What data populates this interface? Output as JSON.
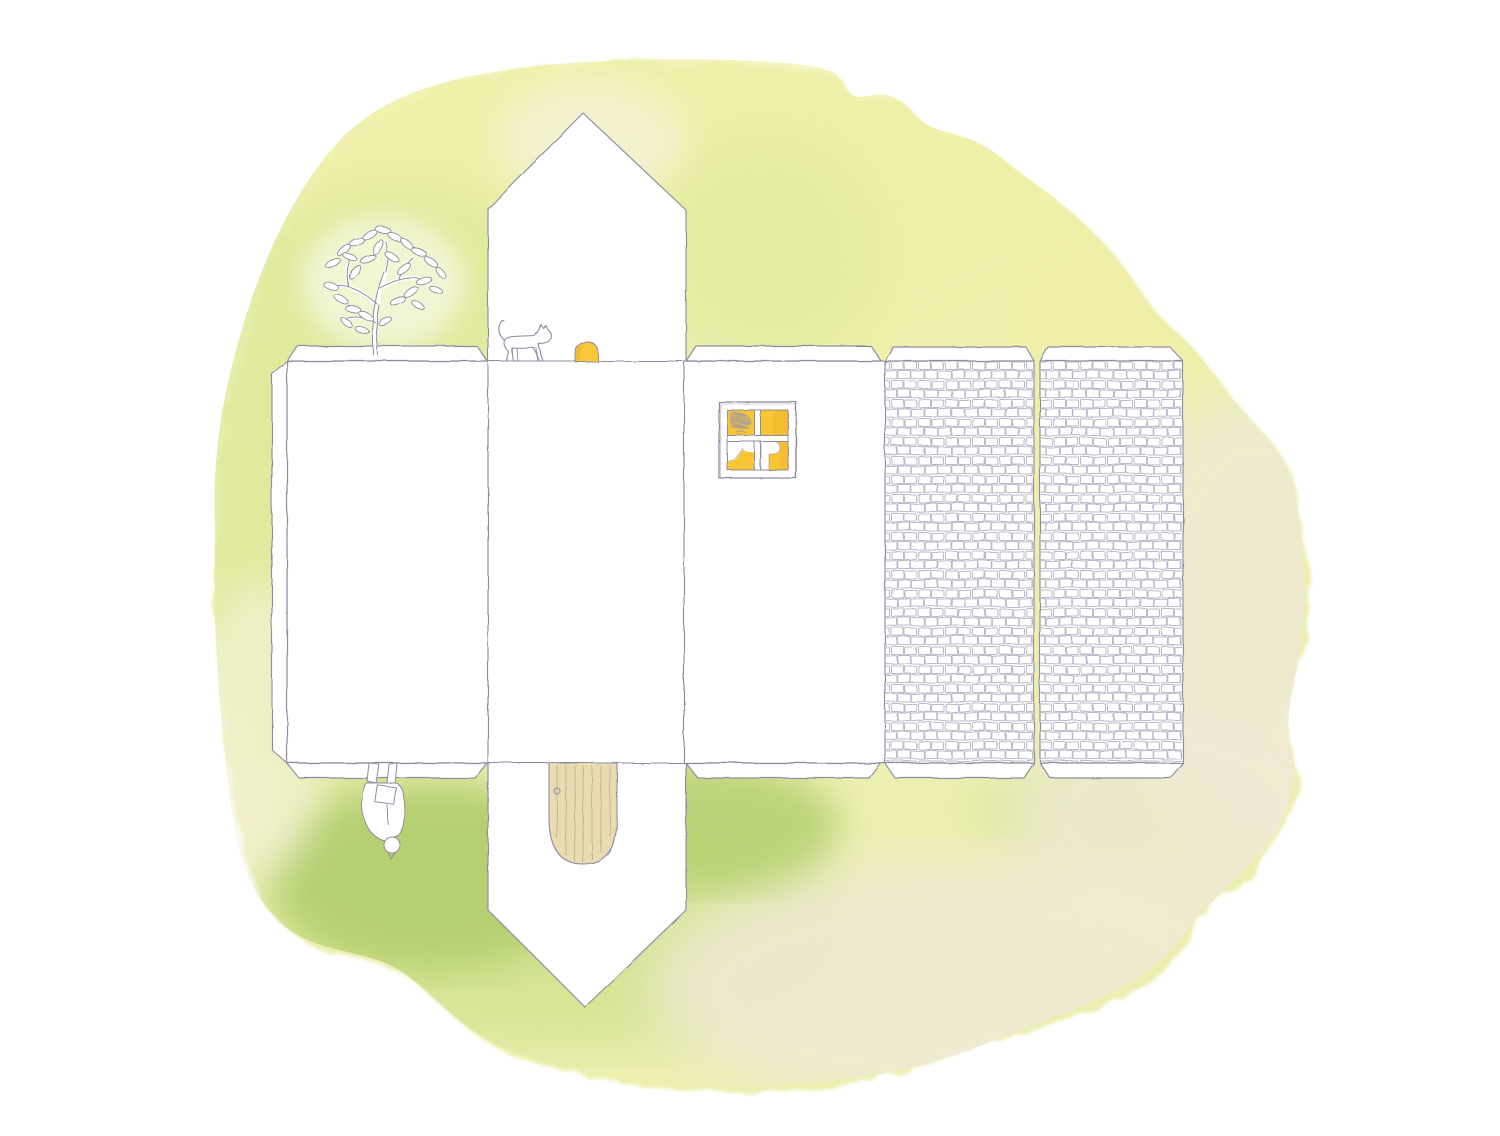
{
  "scene": {
    "type": "watercolor-illustration",
    "subject": "unfolded papercraft house template (net) painted on a yellow-green watercolor wash",
    "elements": [
      "watercolor-wash-background",
      "side-wall-panel-with-glue-flaps",
      "gable-strip-with-top-and-bottom-roof-peaks",
      "front-wall-panel",
      "roof-panel-left-shingled",
      "roof-panel-right-shingled",
      "pencil-tree",
      "walking-cat",
      "small-arched-yellow-door",
      "four-pane-lit-window",
      "arched-wooden-door",
      "upside-down-gardener-figure"
    ]
  },
  "colors": {
    "paper": "#ffffff",
    "pencil": "#8f8ba1",
    "brick_stroke": "#a7a2bc",
    "wash_base": "#edefb0",
    "wash_yellow": "#eff0a8",
    "wash_green_left": "#e0e99c",
    "wash_green_mid": "#cfe18c",
    "wash_green_dark": "#b3cf70",
    "wash_beige": "#efe9d3",
    "wash_pale": "#f6f3df",
    "window_yellow": "#f8c636",
    "window_orange": "#edb028",
    "window_gray": "#9d99ab",
    "door_yellow": "#f7c63b",
    "door_wood": "#e9dcb0",
    "door_grain": "#a9a190"
  }
}
